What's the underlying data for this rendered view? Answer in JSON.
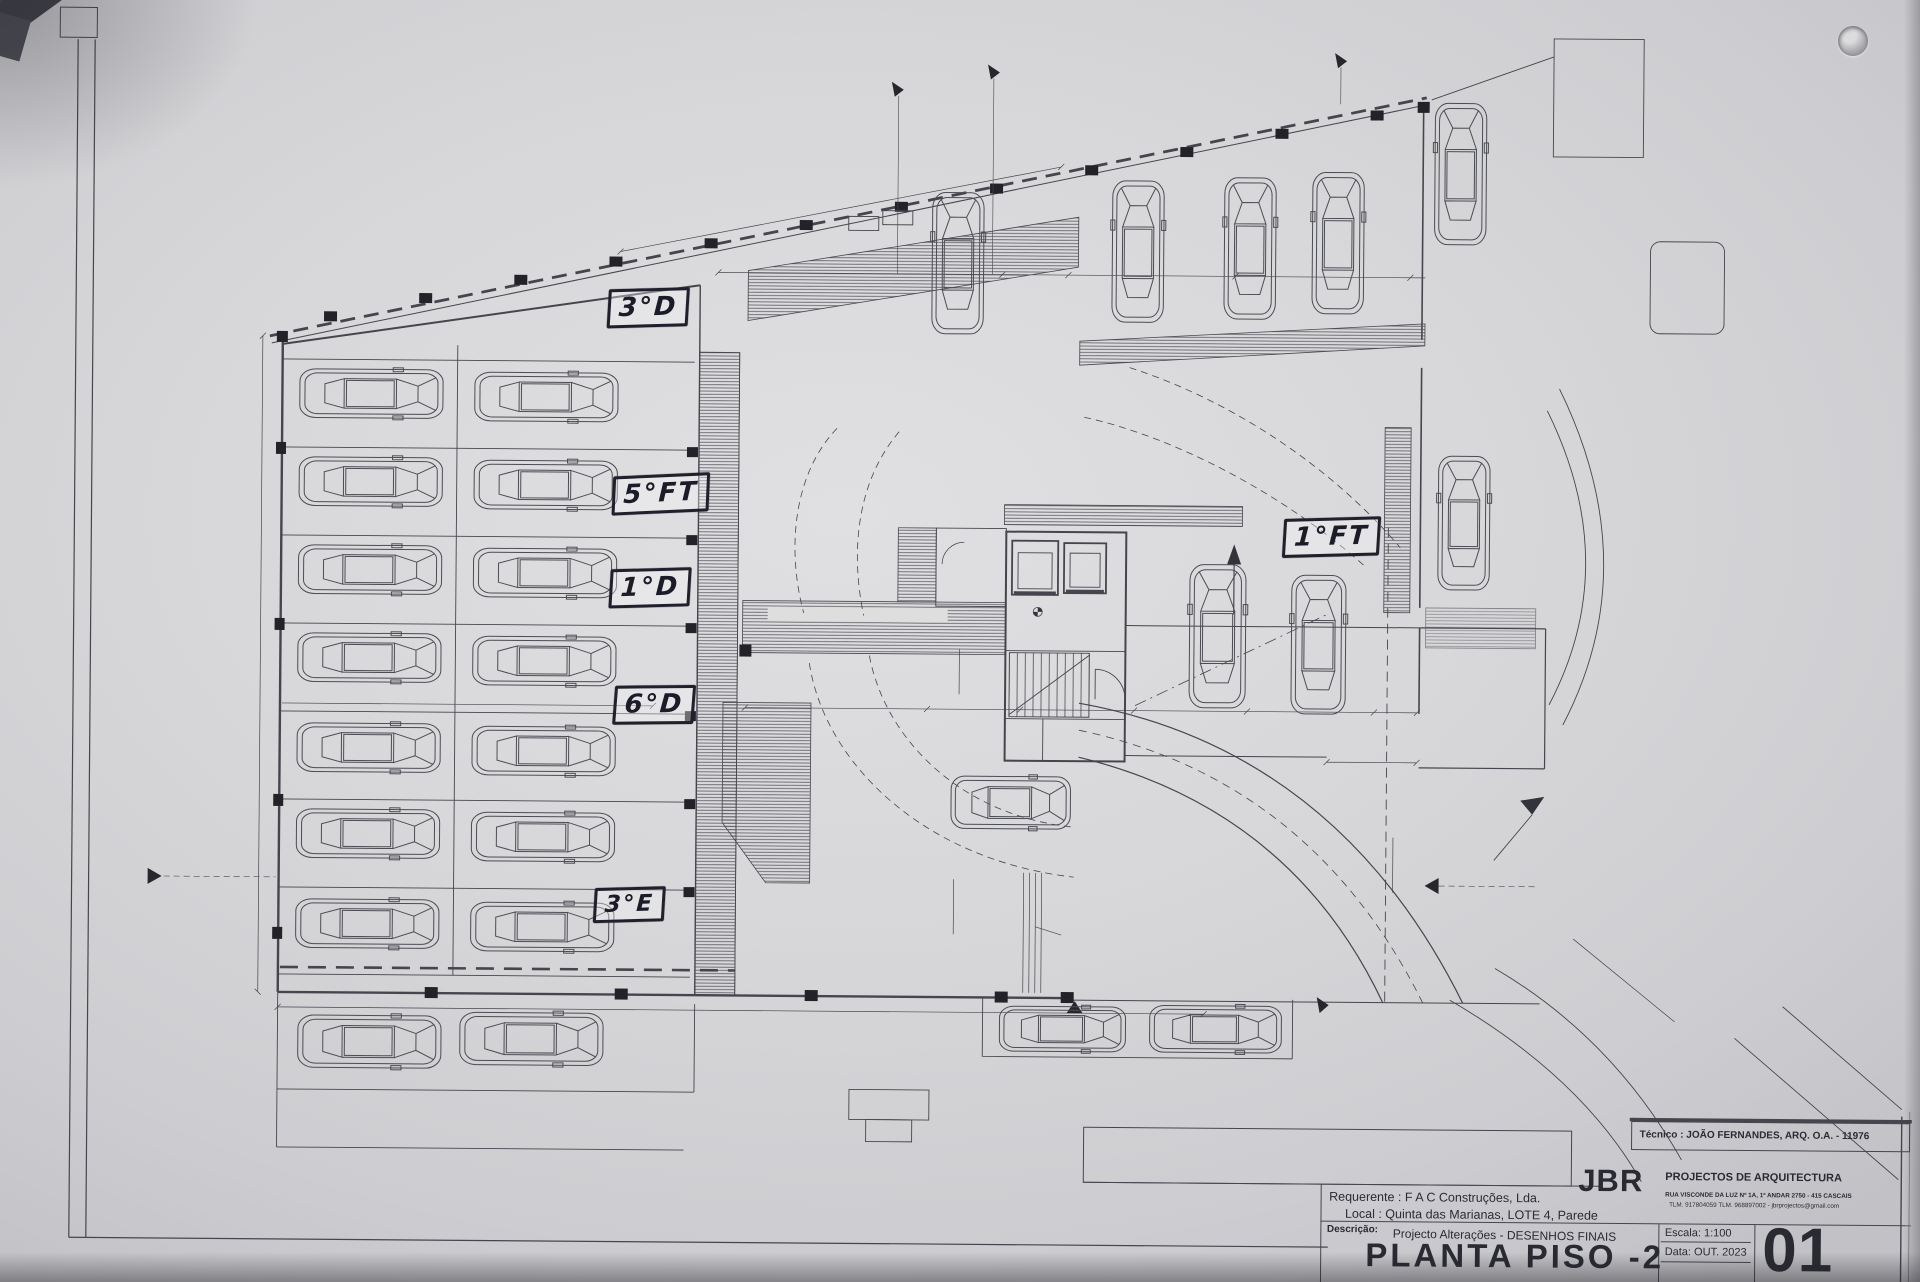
{
  "sheet": {
    "title": "PLANTA PISO -2",
    "number": "01",
    "scale": "Escala: 1:100",
    "date": "Data: OUT. 2023",
    "tecnico": "Técnico : JOÃO FERNANDES, ARQ.   O.A. - 11976",
    "jbr": "JBR",
    "firm": "PROJECTOS DE ARQUITECTURA",
    "addr1": "RUA VISCONDE DA LUZ Nº 1A, 1º ANDAR   2750 - 415 CASCAIS",
    "addr2": "TLM. 917804059  TLM. 968897002  -  jbrprojectos@gmail.com",
    "requerente": "Requerente : F A C  Construções, Lda.",
    "local": "Local : Quinta das Marianas, LOTE 4, Parede",
    "descricao_label": "Descrição:",
    "descricao": "Projecto Alterações - DESENHOS FINAIS"
  },
  "plan": {
    "box": "BOX",
    "handwritten": [
      "3°D",
      "5°FT",
      "1°D",
      "6°D",
      "3°E",
      "1°FT"
    ],
    "stall_codes": [
      "P3 dir",
      "P6 frt.L",
      "P1 dir",
      "P5 dir.",
      "P4 frt.L",
      "P5 esq."
    ],
    "labels": {
      "zona1": "ZONA",
      "zona2": "TÉCNICA",
      "caminho": "CAMINHO  DE  EVACUAÇÃO",
      "arrec": "ARRECADAÇÃO",
      "arrec1_area": "2.50m2",
      "arrec2_area": "3.50m2",
      "rc_dir": "R/C dir.",
      "rc_esq": "R/C esq.",
      "rc_frt": "R/C frt",
      "p2_dir": "P2 dir.",
      "p1_frt": "P1 frt",
      "p4_frt": "P4 frt",
      "lift8": "8 P",
      "lift6": "6 P",
      "level": "22.00",
      "cf60": "CF60",
      "slope": "i = 17.6%",
      "curve_zone": "Zona de Curva Transição"
    },
    "dims": {
      "top_total": "35.32",
      "top_a": "9.60",
      "top_b": "0.10",
      "top_c": "5.65",
      "top_d": "0.10",
      "top_e": "5.80",
      "left_total": "18.98",
      "row_width": "12.60",
      "mid_a": "6.15",
      "mid_b": "3.15",
      "mid_c": "0.20",
      "mid_d": "3.65",
      "mid_e": "0.20",
      "mid_f": "3.60",
      "mid_g": "0.10",
      "mid_h": "4.20",
      "right_a": "3.00",
      "right_b": "5.50",
      "v_a": "1.50",
      "v_b": "3.10",
      "bottom_total": "31.30"
    },
    "sections": {
      "a": "A",
      "d": "D",
      "b": "B",
      "c": "C",
      "cb": "CB"
    }
  }
}
